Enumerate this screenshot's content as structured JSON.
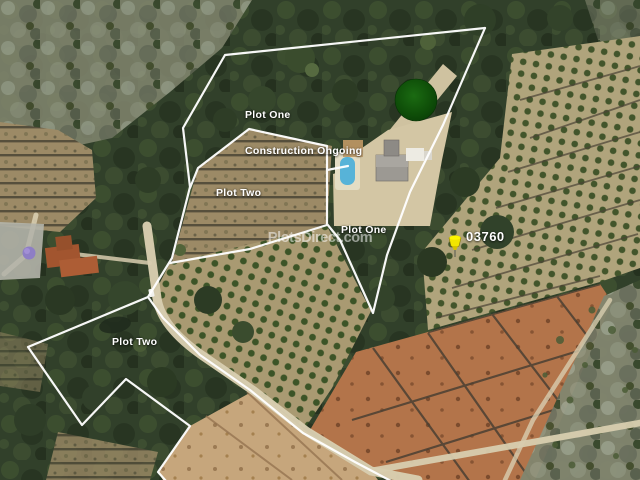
{
  "map": {
    "watermark": "PlotsDirect.com",
    "labels": {
      "plot_one_construction": {
        "line1": "Plot One",
        "line2": "Construction Ongoing"
      },
      "plot_two_upper": "Plot Two",
      "plot_one_mid": "Plot One",
      "plot_two_lower": "Plot Two"
    },
    "marker": {
      "code": "03760",
      "icon": "pushpin-icon",
      "pin_color": "#f2e500"
    },
    "overlay": {
      "boundary_color": "#ffffff",
      "construction_circle_color": "#0d4d08"
    }
  }
}
